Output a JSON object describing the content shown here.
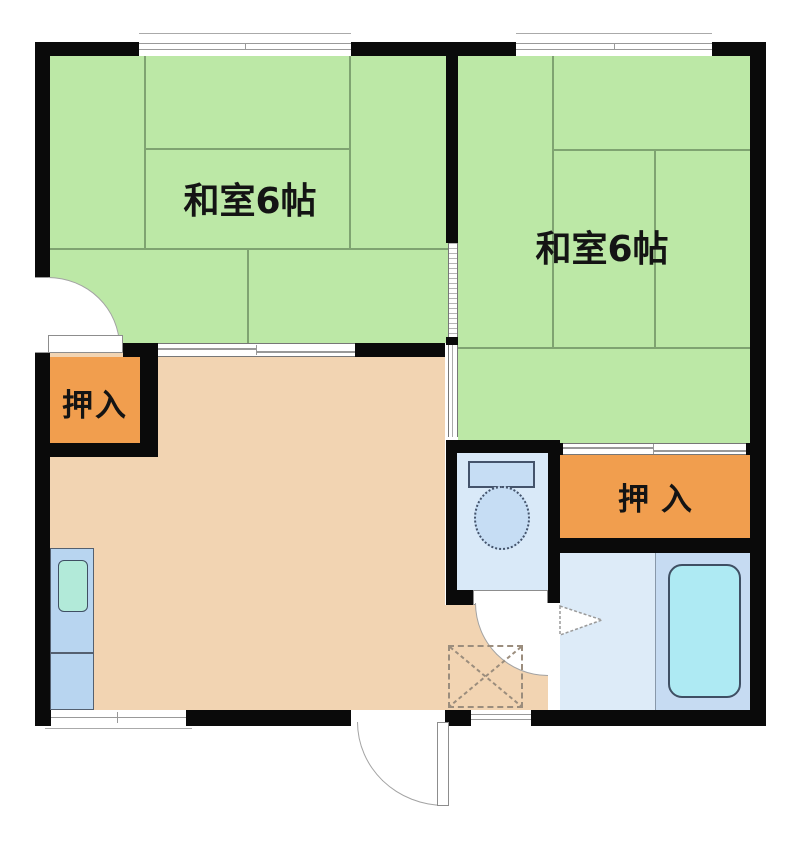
{
  "rooms": {
    "tatami_room_1": {
      "label": "和室6帖"
    },
    "tatami_room_2": {
      "label": "和室6帖"
    },
    "closet_1": {
      "label": "押入"
    },
    "closet_2": {
      "label": "押入"
    }
  },
  "fixtures": {
    "toilet": "toilet-icon",
    "bathtub": "bathtub-icon",
    "kitchen_sink": "kitchen-sink-icon",
    "entrance_mark": "genkan-cross-icon"
  },
  "colors": {
    "tatami_green": "#bce8a6",
    "tatami_line": "#7fa371",
    "dk_floor": "#f2d4b2",
    "closet_orange": "#f19e4e",
    "toilet_room_blue": "#d9e9f8",
    "fixture_blue": "#c6ddf4",
    "kitchen_unit_blue": "#b8d5f0",
    "sink_mint": "#b2ead9",
    "bath_wash_area": "#ddebf8",
    "bathtub_zone": "#c6dbf2",
    "bathtub_fill": "#aeeaf3",
    "wall_black": "#0a0a0a"
  }
}
